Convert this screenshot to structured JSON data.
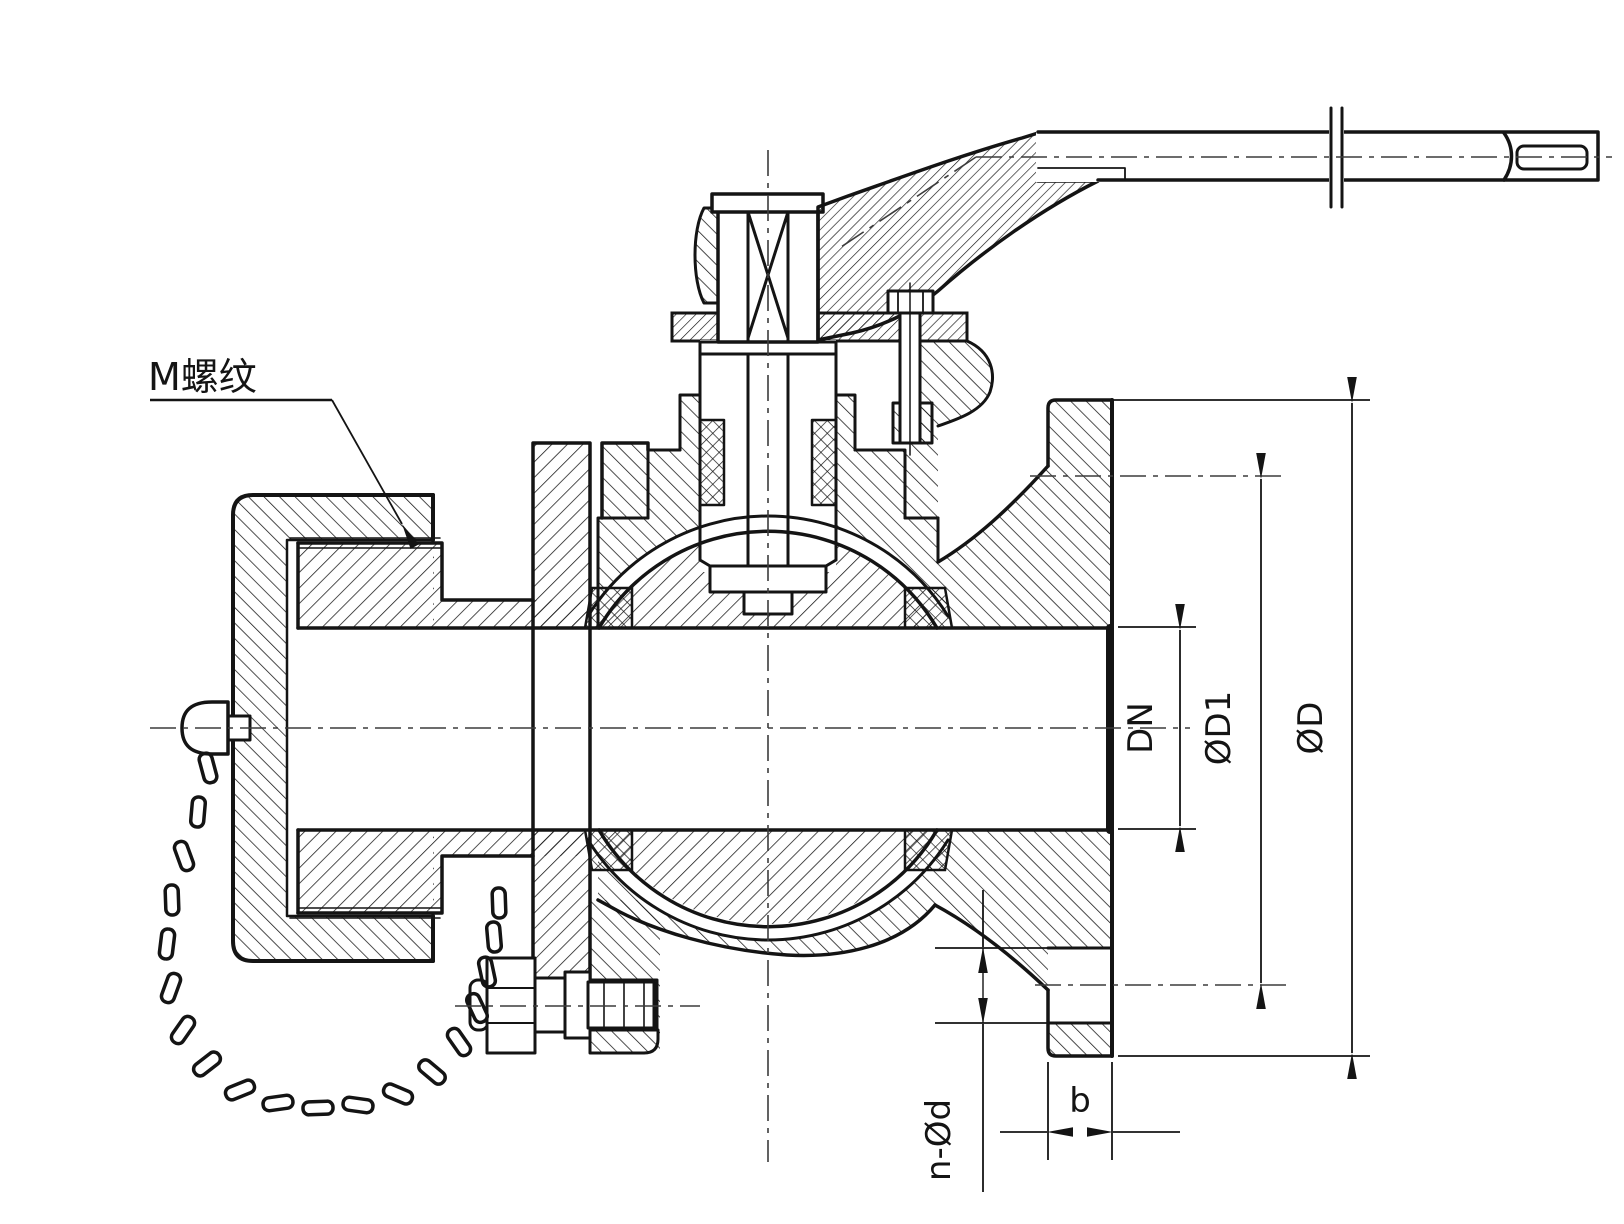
{
  "drawing": {
    "type": "ball-valve-cross-section",
    "labels": {
      "thread": "M螺纹",
      "bore": "DN",
      "bolt_circle": "ØD1",
      "flange_od": "ØD",
      "bolt_holes": "n-Ød",
      "flange_thickness": "b"
    },
    "colors": {
      "line": "#141414",
      "centerline": "#3c3c3c",
      "background": "#ffffff"
    }
  }
}
